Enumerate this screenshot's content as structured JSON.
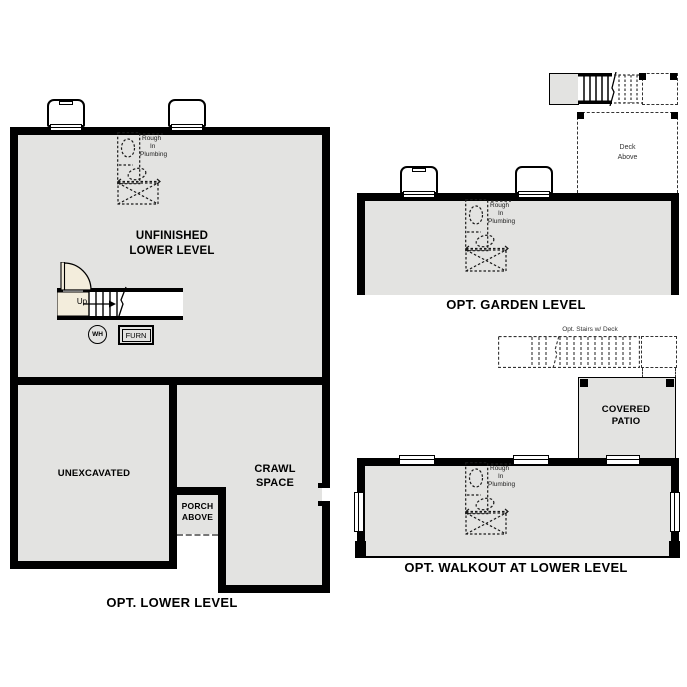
{
  "colors": {
    "background": "#ffffff",
    "wall": "#000000",
    "floor": "#e3e3e1",
    "door": "#f3eddc",
    "dash_gray": "#333333"
  },
  "plumbing": {
    "line1": "Rough",
    "line2": "In",
    "line3": "Plumbing"
  },
  "lower": {
    "title": "OPT. LOWER LEVEL",
    "room": [
      "UNFINISHED",
      "LOWER LEVEL"
    ],
    "unexcavated": "UNEXCAVATED",
    "crawl": [
      "CRAWL",
      "SPACE"
    ],
    "porch": [
      "PORCH",
      "ABOVE"
    ],
    "up": "Up",
    "water_heater": "WH",
    "furnace": "FURN"
  },
  "garden": {
    "title": "OPT. GARDEN LEVEL",
    "deck": [
      "Deck",
      "Above"
    ]
  },
  "walkout": {
    "title": "OPT. WALKOUT AT LOWER LEVEL",
    "stairs_label": "Opt. Stairs w/ Deck",
    "patio": [
      "COVERED",
      "PATIO"
    ]
  }
}
